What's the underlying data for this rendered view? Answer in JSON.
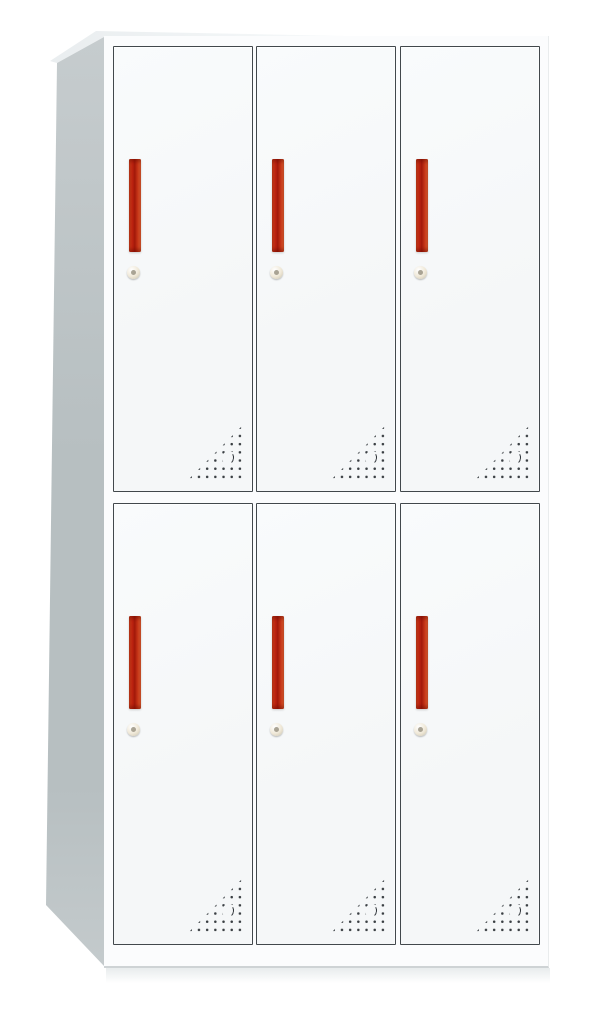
{
  "image": {
    "description": "Product photo of a white six-door steel locker cabinet, two rows by three columns, each door with a red vertical handle, a round cam lock and a triangular pattern of ventilation holes in the bottom-right corner",
    "background": "#ffffff"
  },
  "cabinet": {
    "rows": 2,
    "columns": 3,
    "door_count": 6,
    "handle_orientation": "vertical",
    "vent_pattern": {
      "shape": "right-triangle",
      "rows": 7,
      "columns": 7,
      "accent": "crescent-cutout"
    },
    "colors": {
      "page_background": "#ffffff",
      "front_frame": "#fbfcfd",
      "door_face": "#f5f7f8",
      "door_frame": "#42484c",
      "side_panel": "#b7bfc1",
      "side_panel_light": "#c7cdcf",
      "handle_red_dark": "#bd2310",
      "handle_red_bright": "#ee6c38",
      "lock_body": "#efe8d7",
      "lock_ring": "#c7c0ac",
      "keyhole": "#8f8877",
      "vent_dot": "#3a3f43",
      "base_edge": "#ced3d5",
      "floor_shadow": "#e8eced"
    },
    "doors": [
      {
        "id": "r1-c1",
        "row": 1,
        "col": 1
      },
      {
        "id": "r1-c2",
        "row": 1,
        "col": 2
      },
      {
        "id": "r1-c3",
        "row": 1,
        "col": 3
      },
      {
        "id": "r2-c1",
        "row": 2,
        "col": 1
      },
      {
        "id": "r2-c2",
        "row": 2,
        "col": 2
      },
      {
        "id": "r2-c3",
        "row": 2,
        "col": 3
      }
    ]
  }
}
